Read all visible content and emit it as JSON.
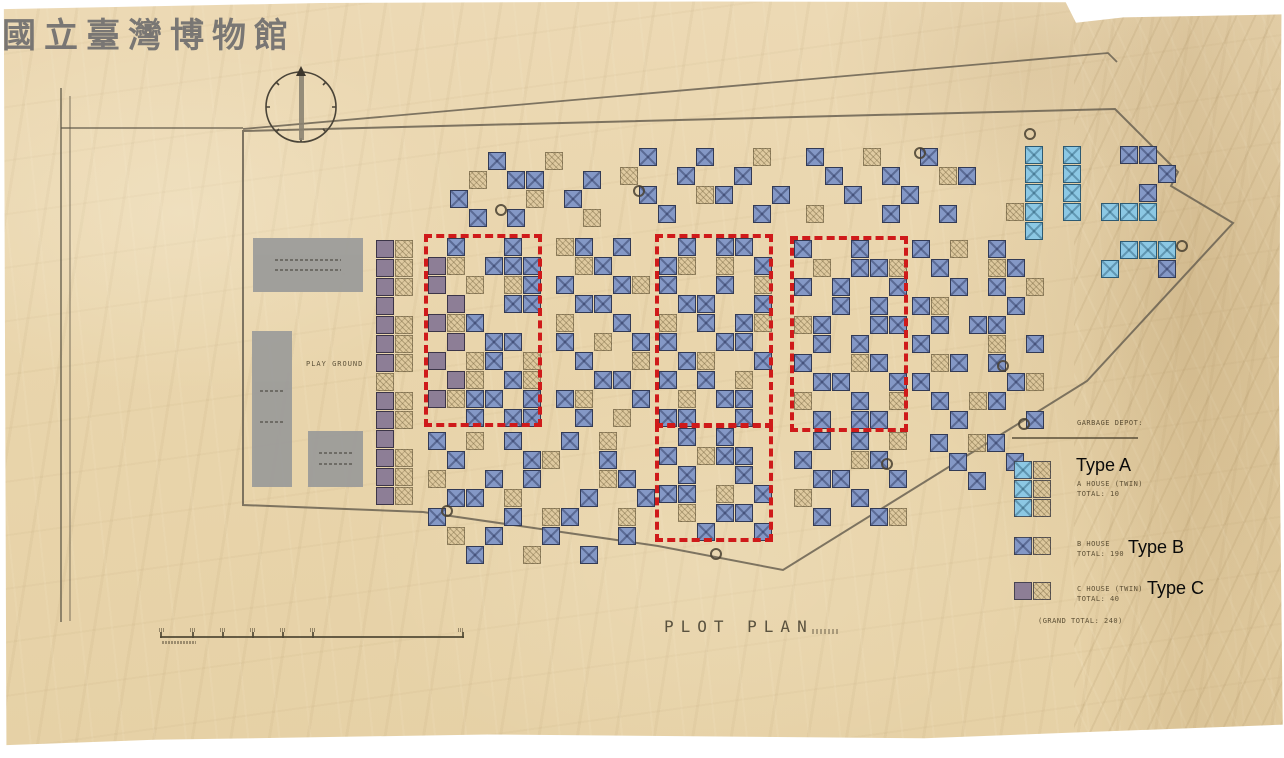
{
  "watermark": "國立臺灣博物館",
  "title": {
    "text": "PLOT PLAN"
  },
  "labels": {
    "play_ground": "PLAY GROUND",
    "type_a": "Type A",
    "type_b": "Type B",
    "type_c": "Type C"
  },
  "legend": {
    "garbage_depot": "GARBAGE DEPOT:",
    "items": [
      {
        "key": "A",
        "line1": "A HOUSE (TWIN)",
        "line2": "TOTAL: 10"
      },
      {
        "key": "B",
        "line1": "B HOUSE",
        "line2": "TOTAL: 190"
      },
      {
        "key": "C",
        "line1": "C HOUSE (TWIN)",
        "line2": "TOTAL: 40"
      }
    ],
    "grand_total": "(GRAND TOTAL: 240)"
  },
  "colors": {
    "type_a": "#8cc8e4",
    "type_b": "#8498c6",
    "type_c": "#8d7e96",
    "red": "#cf1a1a",
    "paper": "#ead7b0",
    "building": "#9c9c9a",
    "line": "#675e4d"
  },
  "map": {
    "cell": 19,
    "blocks": [
      {
        "x": 376,
        "y": 240,
        "rows": [
          "CH",
          "CH",
          "CH",
          "C.",
          "CH",
          "CH",
          "CH",
          "H.",
          "CH",
          "CH",
          "C.",
          "CH",
          "CH",
          "CH"
        ]
      },
      {
        "x": 428,
        "y": 238,
        "rows": [
          ".B..B.",
          "CH.BBB",
          "C.H.HB",
          ".C..BB",
          "CHB...",
          ".C.BB.",
          "C.HB.H",
          ".CH.BH",
          "CHBB.B",
          "..B.BB"
        ]
      },
      {
        "x": 556,
        "y": 238,
        "rows": [
          "HB.B.",
          ".HB..",
          "B..BH",
          ".BB..",
          "H..B.",
          "B.H.B",
          ".B..H",
          "..BB.",
          "BH..B",
          ".B.H."
        ]
      },
      {
        "x": 659,
        "y": 238,
        "rows": [
          ".B.BB.",
          "BH.H.B",
          "B..B.H",
          ".BB..B",
          "H.B.BH",
          "B..BB.",
          ".BH..B",
          "B.B.H.",
          ".H.BB.",
          "BB..B."
        ]
      },
      {
        "x": 794,
        "y": 240,
        "rows": [
          "B..B..",
          ".H.BBH",
          "B.B..B",
          "..B.B.",
          "HB..BB",
          ".B.B..",
          "B..HB.",
          ".BB..B",
          "H..B.H",
          ".B.BB."
        ]
      },
      {
        "x": 659,
        "y": 428,
        "rows": [
          ".B.B..",
          "B.HBB.",
          ".B..B.",
          "BB.H.B",
          ".H.BB.",
          "..B..B"
        ]
      },
      {
        "x": 450,
        "y": 152,
        "rows": [
          "..B..H..",
          ".H.BB..B",
          "B...H.B.",
          ".B.B...H"
        ]
      },
      {
        "x": 620,
        "y": 148,
        "rows": [
          ".B..B..H.",
          "H..B..B..",
          ".B..HB..B",
          "..B....B."
        ]
      },
      {
        "x": 806,
        "y": 148,
        "rows": [
          "B..H..B..",
          ".B..B..HB",
          "..B..B...",
          "H...B..B."
        ]
      },
      {
        "x": 1006,
        "y": 146,
        "rows": [
          ".A.A..BB.",
          ".A.A....B",
          ".A.A...B.",
          "HA.A.AAA.",
          ".A.......",
          "......AAA",
          ".....A..B"
        ]
      },
      {
        "x": 912,
        "y": 240,
        "rows": [
          "B.H.B..",
          ".B..HB.",
          "..B.B.H",
          "BH...B.",
          ".B.BB..",
          "B...H.B",
          ".HB.B..",
          "B....BH",
          ".B.HB..",
          "..B...B"
        ]
      },
      {
        "x": 428,
        "y": 432,
        "rows": [
          "B.H.B..B.H..",
          ".B...BH..B..",
          "H..B.B...HB.",
          ".BB.H...B..B",
          "B...B.HB..H.",
          ".H.B..B...B.",
          "..B..H..B..."
        ]
      },
      {
        "x": 794,
        "y": 432,
        "rows": [
          ".B.B.H",
          "B..HB.",
          ".BB..B",
          "H..B..",
          ".B..BH"
        ]
      },
      {
        "x": 930,
        "y": 434,
        "rows": [
          "B.HB.",
          ".B..B",
          "..B.."
        ]
      }
    ],
    "red_boxes": [
      {
        "x": 424,
        "y": 234,
        "w": 118,
        "h": 193
      },
      {
        "x": 655,
        "y": 234,
        "w": 118,
        "h": 193
      },
      {
        "x": 790,
        "y": 236,
        "w": 118,
        "h": 196
      },
      {
        "x": 655,
        "y": 424,
        "w": 118,
        "h": 118
      }
    ],
    "depots": [
      {
        "x": 495,
        "y": 204
      },
      {
        "x": 633,
        "y": 185
      },
      {
        "x": 914,
        "y": 147
      },
      {
        "x": 1024,
        "y": 128
      },
      {
        "x": 1176,
        "y": 240
      },
      {
        "x": 997,
        "y": 360
      },
      {
        "x": 881,
        "y": 458
      },
      {
        "x": 710,
        "y": 548
      },
      {
        "x": 441,
        "y": 505
      }
    ],
    "buildings": [
      {
        "x": 253,
        "y": 238,
        "w": 110,
        "h": 54
      },
      {
        "x": 252,
        "y": 331,
        "w": 40,
        "h": 156
      },
      {
        "x": 308,
        "y": 431,
        "w": 55,
        "h": 56
      }
    ]
  }
}
